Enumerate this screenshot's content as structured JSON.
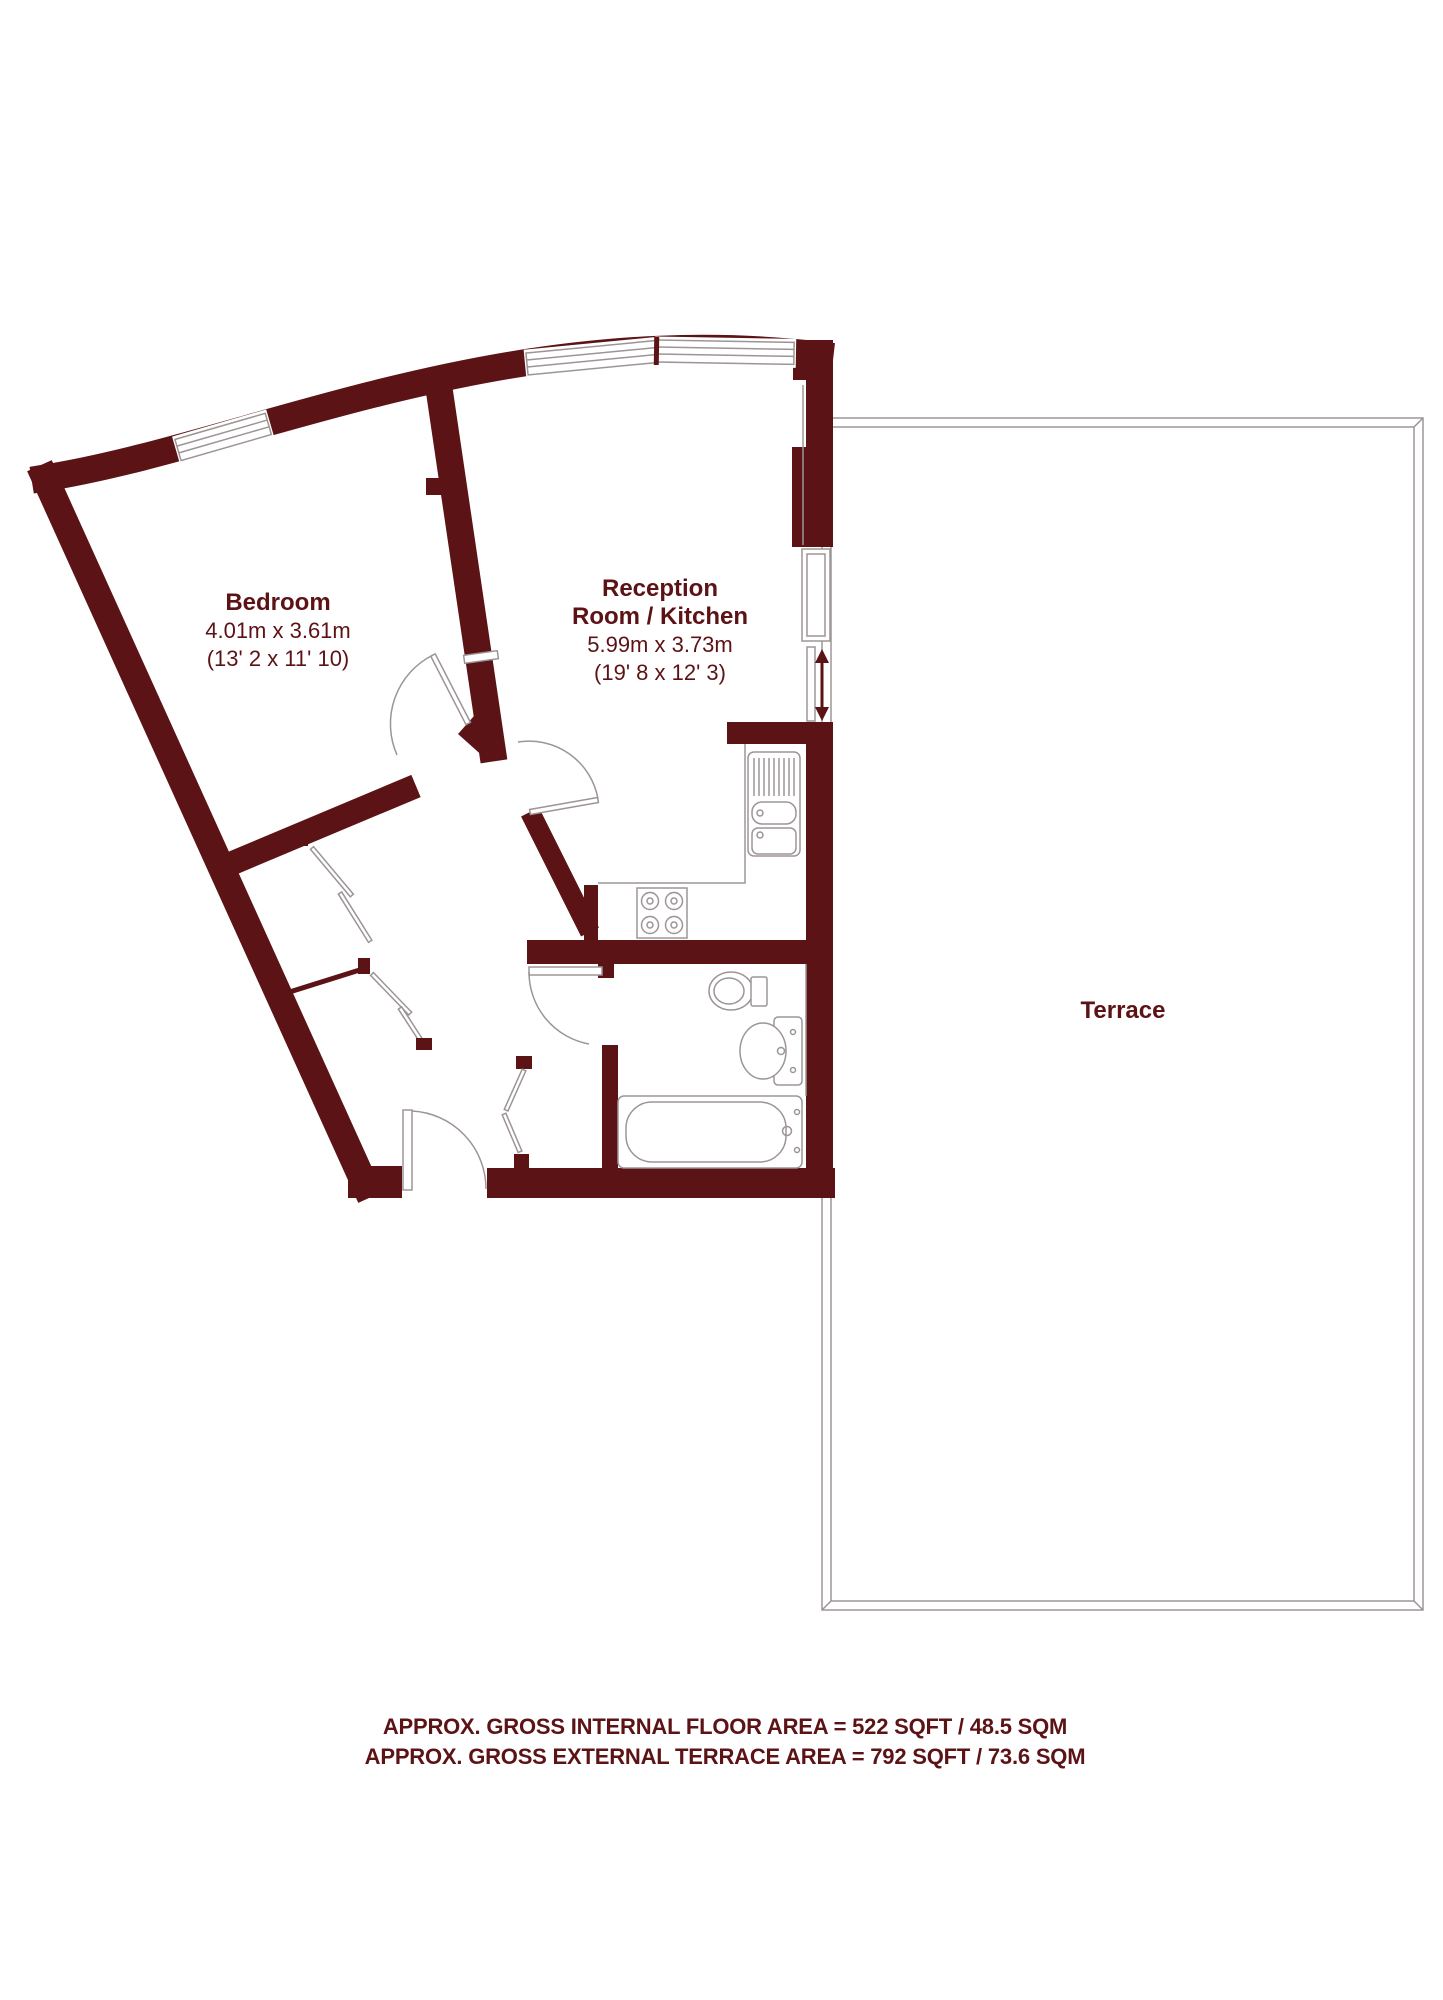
{
  "plan": {
    "rooms": {
      "bedroom": {
        "name": "Bedroom",
        "size_metric": "4.01m x 3.61m",
        "size_imperial": "(13' 2 x 11' 10)"
      },
      "reception": {
        "name_line1": "Reception",
        "name_line2": "Room / Kitchen",
        "size_metric": "5.99m x 3.73m",
        "size_imperial": "(19' 8 x 12' 3)"
      },
      "terrace": {
        "name": "Terrace"
      }
    },
    "footer": {
      "line1": "APPROX. GROSS INTERNAL FLOOR AREA = 522 SQFT / 48.5 SQM",
      "line2": "APPROX. GROSS EXTERNAL TERRACE AREA = 792 SQFT / 73.6 SQM"
    },
    "colors": {
      "wall": "#5C1316",
      "outline": "#9D9595",
      "text": "#5C1316",
      "background": "#FFFFFF"
    }
  }
}
